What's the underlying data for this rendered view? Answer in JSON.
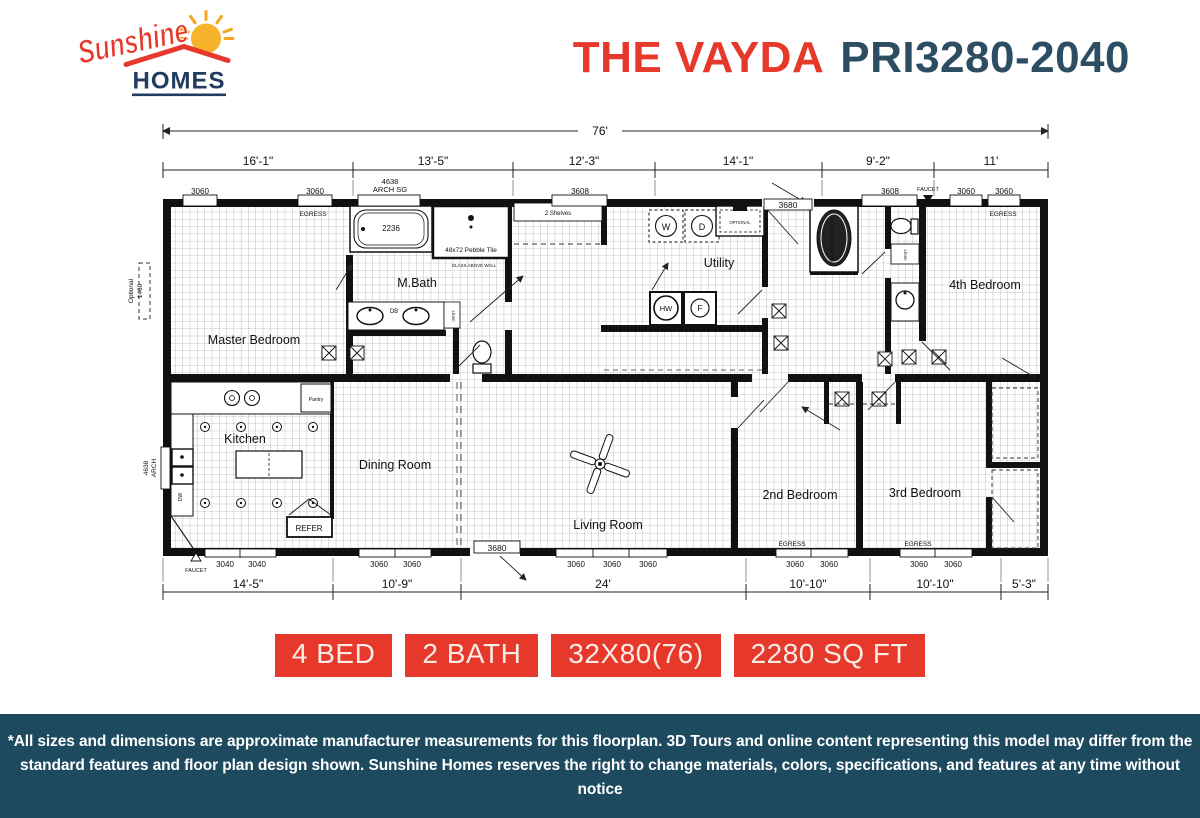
{
  "colors": {
    "red": "#e6392c",
    "navy": "#2d4d63",
    "band_bg": "#1e4a5f",
    "logo_navy": "#223c5f",
    "sun": "#f7a92c"
  },
  "logo": {
    "script": "Sunshine",
    "word": "HOMES"
  },
  "header": {
    "model_name": "THE VAYDA",
    "model_number": "PRI3280-2040"
  },
  "badges": [
    {
      "label": "4 BED"
    },
    {
      "label": "2 BATH"
    },
    {
      "label": "32X80(76)"
    },
    {
      "label": "2280 SQ FT"
    }
  ],
  "disclaimer": {
    "line1": "*All sizes and dimensions are approximate manufacturer measurements for this floorplan. 3D Tours and online content representing this model may differ from the",
    "line2": "standard features and floor plan design shown. Sunshine Homes reserves the right to change materials, colors, specifications, and features at any time without notice"
  },
  "plan": {
    "overall_width": "76'",
    "top_dims": [
      "16'-1\"",
      "13'-5\"",
      "12'-3\"",
      "14'-1\"",
      "9'-2\"",
      "11'"
    ],
    "bottom_dims": [
      "14'-5\"",
      "10'-9\"",
      "24'",
      "10'-10\"",
      "10'-10\"",
      "5'-3\""
    ],
    "rooms": {
      "master": "Master Bedroom",
      "mbath": "M.Bath",
      "utility": "Utility",
      "bed4": "4th Bedroom",
      "kitchen": "Kitchen",
      "dining": "Dining Room",
      "living": "Living Room",
      "bed2": "2nd Bedroom",
      "bed3": "3rd Bedroom"
    },
    "win_top": [
      "3060",
      "3060",
      "3608",
      "3608",
      "3060",
      "3060"
    ],
    "win_bottom": [
      "3040",
      "3040",
      "3060",
      "3060",
      "3060",
      "3060",
      "3060",
      "3060",
      "3060",
      "3060",
      "3060"
    ],
    "labels": {
      "egress": "EGRESS",
      "faucet": "FAUCET",
      "door": "3680",
      "arch_top_1": "4638",
      "arch_top_2": "ARCH SG",
      "arch_left_1": "4638",
      "arch_left_2": "ARCH",
      "optional_left_1": "Optional",
      "optional_left_2": "1460"
    },
    "fixtures": {
      "tub": "2236",
      "shower": "48x72 Pebble Tile",
      "glass": "GLASS ABOVE WALL",
      "double_bowl": "DB",
      "linen": "Linen",
      "shelves": "2 Shelves",
      "washer": "W",
      "dryer": "D",
      "water_heater": "HW",
      "furnace": "F",
      "optional": "OPTIONAL",
      "garden_tub": "60x43 VERA TUB",
      "pantry": "Pantry",
      "dishwasher": "DW",
      "refrigerator": "REFER"
    }
  }
}
